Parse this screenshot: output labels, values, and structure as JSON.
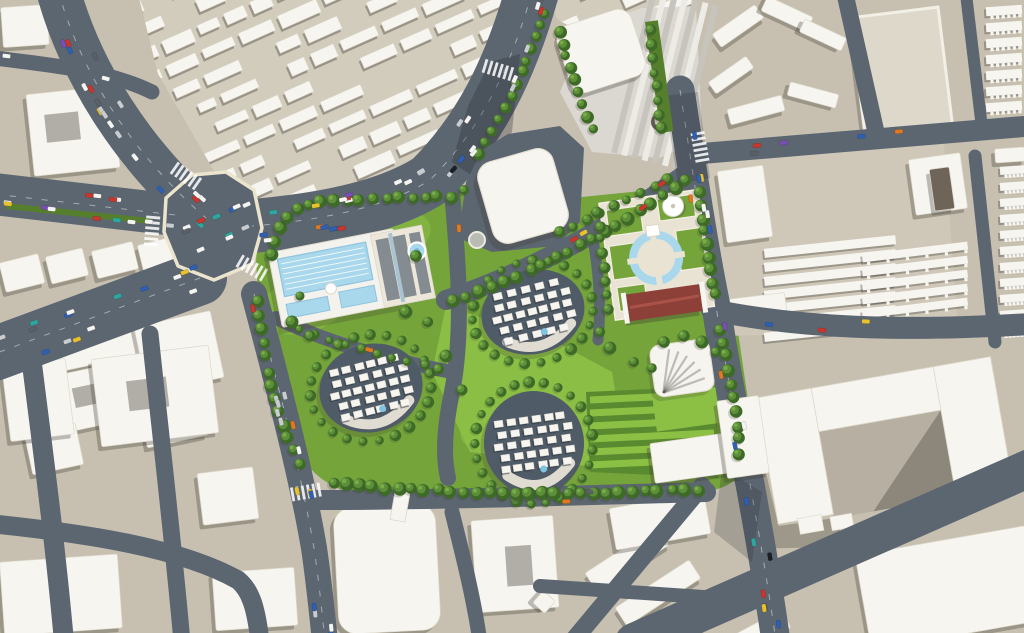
{
  "meta": {
    "kind": "aerial-3d-masterplan-rendering",
    "canvas_w": 1024,
    "canvas_h": 633
  },
  "palette": {
    "ground": "#c7c0b1",
    "ground_light": "#d2ccbd",
    "road": "#5c6671",
    "road_dark": "#4d5761",
    "curb": "#ece5cd",
    "white": "#f7f5f0",
    "white_edge": "#ddd8ca",
    "shadow": "#3e3a33",
    "lawn": "#75a43a",
    "lawn_bright": "#8cc045",
    "lawn_dark": "#567f2d",
    "hedge_base": "#5a8a30",
    "tree_dark": "#3e6a27",
    "tree_mid": "#5d8f3b",
    "tree_light": "#79ad46",
    "water": "#a9d8ec",
    "water_deep": "#7fbcd9",
    "cluster_ground": "#4f5b66",
    "plaza_cream": "#e9e3d4",
    "track_red": "#8d4038",
    "track_ridge": "#a85248",
    "roof_gray": "#848b91",
    "roof_spine": "#aac3d1",
    "complex_base": "#dbd8d1",
    "strip_dark": "#c6c4bd",
    "strip_light": "#edebe6",
    "tower_dark": "#6e6458",
    "court_tan": "#b6afa2",
    "plaza_tan": "#d9d3c4",
    "walkway": "#e8e4d8",
    "crescent": "#5f5a52"
  },
  "car_colors": [
    [
      "#f4f4f2",
      30
    ],
    [
      "#c9ccd0",
      16
    ],
    [
      "#5a6066",
      12
    ],
    [
      "#c8372d",
      9
    ],
    [
      "#2f5fb3",
      9
    ],
    [
      "#e8c22e",
      8
    ],
    [
      "#2da8a0",
      6
    ],
    [
      "#e07820",
      5
    ],
    [
      "#7a4fb5",
      3
    ],
    [
      "#1c1f24",
      2
    ]
  ],
  "roads": [
    {
      "name": "avenue-northwest",
      "d": "M 58,-10 C 80,70 130,152 206,218",
      "w": 44,
      "cars": 20,
      "dash": true
    },
    {
      "name": "avenue-top",
      "d": "M 532,-8 C 510,70 480,130 430,180 C 380,212 300,222 252,226",
      "w": 54,
      "cars": 30,
      "dash": true
    },
    {
      "name": "avenue-west",
      "d": "M -6,194 L 184,216",
      "w": 42,
      "cars": 13,
      "dash": true
    },
    {
      "name": "avenue-southwest",
      "d": "M 200,278 L -6,354",
      "w": 54,
      "cars": 15,
      "dash": true
    },
    {
      "name": "road-west-edge",
      "d": "M 254,294 C 282,400 302,478 314,548 C 319,582 322,612 325,642",
      "w": 26,
      "cars": 16,
      "dash": true
    },
    {
      "name": "road-east",
      "d": "M 680,90 C 692,168 704,248 716,306 C 726,372 740,440 750,484 C 758,528 768,584 776,642",
      "w": 29,
      "cars": 18,
      "dash": true
    },
    {
      "name": "road-dev-diagonal",
      "d": "M 446,300 C 540,268 626,218 694,168",
      "w": 20,
      "cars": 4
    },
    {
      "name": "road-dev-east-of-pool",
      "d": "M 452,192 C 458,260 464,330 452,392 C 446,420 442,452 448,478",
      "w": 16,
      "cars": 1
    },
    {
      "name": "road-dev-west-walk",
      "d": "M 276,318 C 340,348 400,362 452,372",
      "w": 14,
      "cars": 1
    },
    {
      "name": "path-dev-mid",
      "d": "M 590,224 C 598,262 602,300 598,340",
      "w": 11,
      "cars": 0
    },
    {
      "name": "road-dev-south",
      "d": "M 312,500 C 430,500 560,496 706,492",
      "w": 20,
      "cars": 2
    },
    {
      "name": "road-bottom-diagonal",
      "d": "M 702,486 L 572,642",
      "w": 18,
      "cars": 0
    },
    {
      "name": "road-bottom-branch",
      "d": "M 540,586 C 600,590 660,594 718,598",
      "w": 14,
      "cars": 0
    },
    {
      "name": "road-bottom-center",
      "d": "M 452,512 C 464,560 474,600 480,642",
      "w": 15,
      "cars": 0
    },
    {
      "name": "road-topright-horizontal",
      "d": "M 696,154 L 1030,126",
      "w": 21,
      "cars": 5
    },
    {
      "name": "road-topright-vertical",
      "d": "M 845,-6 L 876,132",
      "w": 17,
      "cars": 0
    },
    {
      "name": "road-topright-edge",
      "d": "M 966,-6 L 982,128",
      "w": 12,
      "cars": 0
    },
    {
      "name": "road-right-vertical",
      "d": "M 975,156 L 995,342",
      "w": 13,
      "cars": 0
    },
    {
      "name": "road-mid-right",
      "d": "M 712,310 C 800,328 900,332 1030,324",
      "w": 22,
      "cars": 3
    },
    {
      "name": "road-bottom-right",
      "d": "M 634,642 L 1030,468",
      "w": 38,
      "cars": 0
    },
    {
      "name": "road-bottomleft-v1",
      "d": "M 28,332 C 40,430 54,530 64,642",
      "w": 20,
      "cars": 0
    },
    {
      "name": "road-bottomleft-v2",
      "d": "M 150,334 C 160,430 172,530 182,642",
      "w": 17,
      "cars": 0
    },
    {
      "name": "road-bottomleft-h",
      "d": "M -6,524 C 90,534 180,548 238,580 C 250,590 256,606 260,642",
      "w": 19,
      "cars": 0
    },
    {
      "name": "road-topleft-spur",
      "d": "M -6,58 C 60,66 112,72 152,92",
      "w": 15,
      "cars": 2
    },
    {
      "name": "plaza-traffic",
      "d": "M 178,246 L 256,212",
      "w": 58,
      "cars": 11,
      "ghost": true
    }
  ],
  "intersection_plaza": {
    "name": "central-intersection",
    "points": "166,198 192,175 226,172 254,190 262,228 252,264 214,280 178,266 164,232"
  },
  "median": {
    "name": "avenue-west-median",
    "d": "M 6,206 L 150,221",
    "w": 6
  },
  "patches": [
    {
      "name": "building-shadow-on-avenue",
      "points": "452,162 468,106 490,62 520,54 512,132 478,180",
      "op": 0.3
    },
    {
      "name": "building-shadow-on-east-road",
      "points": "664,96 698,92 710,178 678,184",
      "op": 0.22
    },
    {
      "name": "tower-shadow-on-road",
      "points": "722,468 762,492 752,562 714,532",
      "op": 0.22
    }
  ],
  "zebras": [
    [
      186,
      176,
      35
    ],
    [
      152,
      231,
      95
    ],
    [
      252,
      268,
      30
    ],
    [
      700,
      147,
      80
    ],
    [
      306,
      492,
      -10
    ],
    [
      498,
      70,
      17
    ]
  ],
  "development": {
    "outline": "M 256,262 C 258,224 268,208 300,198 L 448,190 C 460,190 468,196 470,204 L 522,206 L 582,197 L 700,185 C 710,184 716,190 716,198 L 720,300 C 722,316 730,322 738,332 L 748,400 C 752,432 750,460 742,472 C 730,488 716,490 700,492 L 400,498 C 360,498 330,490 312,470 C 290,445 272,400 262,350 Z",
    "bright_patches": [
      [
        300,
        308,
        44,
        26,
        -10
      ],
      [
        372,
        240,
        60,
        30,
        -14
      ],
      [
        520,
        430,
        60,
        26,
        -5
      ]
    ],
    "central_lawn": "446,306 560,344 612,372 616,396 588,466 470,452 432,372",
    "hedges": {
      "base": "586,392 716,386 718,478 590,472",
      "rows": 6,
      "x0": 590,
      "x1": 714,
      "y0": 400,
      "dy": 13,
      "slope": -6
    },
    "clusters": [
      {
        "name": "residential-cluster-west",
        "cx": 371,
        "cy": 388,
        "rx": 52,
        "ry": 44,
        "rot": -14,
        "seed": 7
      },
      {
        "name": "residential-cluster-north",
        "cx": 533,
        "cy": 312,
        "rx": 52,
        "ry": 42,
        "rot": -14,
        "seed": 11
      },
      {
        "name": "residential-cluster-south",
        "cx": 534,
        "cy": 443,
        "rx": 50,
        "ry": 52,
        "rot": -8,
        "seed": 19
      }
    ],
    "pool": {
      "name": "swimming-pool-complex",
      "cx": 338,
      "cy": 278,
      "rot": -11
    },
    "pond": {
      "name": "round-pond",
      "cx": 417,
      "cy": 251,
      "r": 8.5
    },
    "planter": {
      "name": "round-planter",
      "cx": 477,
      "cy": 240,
      "r": 8
    },
    "apron": "458,238 466,182 482,150 508,134 560,126 584,148 580,222 556,246 492,252",
    "hall": {
      "name": "white-hall-building",
      "x": 484,
      "y": 154,
      "w": 78,
      "h": 84,
      "rot": -16,
      "r": 16
    },
    "ne_plaza": {
      "name": "fountain-plaza",
      "rot": -8,
      "cx": 655,
      "cy": 250,
      "plaza": [
        606,
        196,
        100,
        118
      ],
      "lawns": [
        [
          612,
          204,
          34,
          26
        ],
        [
          664,
          200,
          36,
          22
        ],
        [
          610,
          240,
          26,
          34
        ],
        [
          678,
          234,
          26,
          40
        ],
        [
          612,
          282,
          28,
          24
        ]
      ],
      "pool_r": 27,
      "island_r": 19,
      "center": [
        655,
        258
      ],
      "dome": {
        "cx": 679,
        "cy": 209,
        "r": 10.5
      },
      "red_building": {
        "x": 620,
        "y": 290,
        "w": 74,
        "h": 27
      }
    },
    "se_corner": {
      "canopy": {
        "cx": 682,
        "cy": 368,
        "rot": -8
      },
      "lawn": [
        652,
        396,
        64,
        36,
        -8
      ],
      "l_building": [
        [
          652,
          436,
          108,
          40,
          -8
        ],
        [
          722,
          398,
          42,
          78,
          -8
        ]
      ]
    },
    "bridge": {
      "name": "pedestrian-bridge",
      "x": 396,
      "y": 486,
      "w": 15,
      "h": 34,
      "rot": 10
    }
  },
  "tree_rows": [
    {
      "name": "trees-dev-north",
      "d": "M 272,254 C 278,220 296,206 322,202 L 444,196",
      "sp": 13,
      "r": 5.2
    },
    {
      "name": "trees-diagonal-south",
      "d": "M 452,302 C 540,272 628,222 692,176",
      "sp": 14,
      "r": 5.2
    },
    {
      "name": "trees-diagonal-north",
      "d": "M 560,232 C 610,210 650,190 678,172",
      "sp": 15,
      "r": 4.4
    },
    {
      "name": "trees-plaza-east",
      "d": "M 700,192 C 706,242 712,272 716,304",
      "sp": 13,
      "r": 5
    },
    {
      "name": "trees-plaza-west",
      "d": "M 598,212 C 602,250 606,285 610,318",
      "sp": 14,
      "r": 4.4
    },
    {
      "name": "trees-dev-south",
      "d": "M 334,484 C 450,494 560,496 700,490",
      "sp": 13,
      "r": 5.4
    },
    {
      "name": "trees-dev-west",
      "d": "M 258,302 C 264,364 282,432 300,464",
      "sp": 14,
      "r": 5.2
    },
    {
      "name": "trees-avenue-east",
      "d": "M 545,12 C 528,60 508,112 474,160",
      "sp": 13,
      "r": 4.8
    },
    {
      "name": "trees-se-corner",
      "d": "M 720,330 C 732,380 740,430 738,464",
      "sp": 14,
      "r": 5
    },
    {
      "name": "trees-complex-west",
      "d": "M 560,30 C 570,72 584,110 598,140",
      "sp": 13,
      "r": 4.6
    },
    {
      "name": "trees-green-strip",
      "d": "M 650,30 L 662,132",
      "sp": 14,
      "r": 4.4
    },
    {
      "name": "trees-inner-walk",
      "d": "M 300,330 C 360,352 410,362 448,370",
      "sp": 16,
      "r": 3.8
    }
  ],
  "tree_singles": [
    [
      416,
      256
    ],
    [
      428,
      322
    ],
    [
      446,
      356
    ],
    [
      462,
      390
    ],
    [
      610,
      348
    ],
    [
      634,
      362
    ],
    [
      652,
      368
    ],
    [
      600,
      332
    ],
    [
      292,
      322
    ],
    [
      310,
      336
    ],
    [
      406,
      312
    ],
    [
      300,
      296
    ],
    [
      664,
      342
    ],
    [
      684,
      336
    ],
    [
      702,
      342
    ],
    [
      716,
      352
    ],
    [
      452,
      198
    ],
    [
      464,
      190
    ]
  ],
  "green_strip": {
    "name": "green-median-strip",
    "x": 645,
    "y": 22,
    "w": 13,
    "h": 112,
    "rot": -8
  },
  "fabric_regions": [
    {
      "name": "city-fabric-northwest",
      "clip": "138,-6 516,-6 496,54 462,110 430,160 382,196 330,206 240,216 158,74",
      "rot": -24,
      "cx": 320,
      "cy": 100,
      "x0": -60,
      "x1": 640,
      "y0": -90,
      "y1": 300,
      "row": 24,
      "seed": 3
    },
    {
      "name": "city-fabric-north",
      "clip": "544,-6 692,-6 690,32 640,58 600,42 558,20",
      "rot": -24,
      "cx": 610,
      "cy": 20,
      "x0": 440,
      "x1": 750,
      "y0": -70,
      "y1": 90,
      "row": 24,
      "seed": 5
    }
  ],
  "buildings": [
    {
      "name": "block-topleft-a",
      "x": 2,
      "y": 6,
      "w": 46,
      "h": 40,
      "rot": -4
    },
    {
      "name": "block-topleft-b",
      "x": 30,
      "y": 90,
      "w": 86,
      "h": 82,
      "rot": -6,
      "notch": [
        46,
        112,
        34,
        28
      ]
    },
    {
      "name": "block-west-1",
      "x": 2,
      "y": 258,
      "w": 40,
      "h": 30,
      "rot": -14
    },
    {
      "name": "block-west-2",
      "x": 48,
      "y": 252,
      "w": 38,
      "h": 28,
      "rot": -14
    },
    {
      "name": "block-west-3",
      "x": 94,
      "y": 246,
      "w": 42,
      "h": 28,
      "rot": -14
    },
    {
      "name": "block-west-4",
      "x": 140,
      "y": 240,
      "w": 42,
      "h": 28,
      "rot": -14
    },
    {
      "name": "block-west-5",
      "x": 52,
      "y": 302,
      "w": 82,
      "h": 62,
      "rot": -12,
      "notch": [
        82,
        318,
        26,
        22
      ]
    },
    {
      "name": "block-west-6",
      "x": 140,
      "y": 318,
      "w": 78,
      "h": 68,
      "rot": -12
    },
    {
      "name": "block-west-7",
      "x": 58,
      "y": 368,
      "w": 72,
      "h": 58,
      "rot": -12,
      "notch": [
        74,
        384,
        24,
        20
      ]
    },
    {
      "name": "block-west-8",
      "x": 142,
      "y": 396,
      "w": 62,
      "h": 46,
      "rot": -12
    },
    {
      "name": "block-west-9",
      "x": 28,
      "y": 428,
      "w": 52,
      "h": 42,
      "rot": -12
    },
    {
      "name": "block-southwest-1",
      "x": 96,
      "y": 352,
      "w": 118,
      "h": 88,
      "rot": -7,
      "notch": [
        128,
        378,
        40,
        30
      ]
    },
    {
      "name": "block-southwest-2",
      "x": 6,
      "y": 362,
      "w": 64,
      "h": 76,
      "rot": -7
    },
    {
      "name": "block-southwest-3",
      "x": 200,
      "y": 470,
      "w": 56,
      "h": 52,
      "rot": -7
    },
    {
      "name": "block-southwest-4",
      "x": 2,
      "y": 558,
      "w": 118,
      "h": 74,
      "rot": -4
    },
    {
      "name": "block-southwest-5",
      "x": 214,
      "y": 570,
      "w": 82,
      "h": 58,
      "rot": -4
    },
    {
      "name": "block-bottomcenter-rounded",
      "x": 336,
      "y": 506,
      "w": 102,
      "h": 126,
      "rot": -3,
      "r": 18
    },
    {
      "name": "block-bottomcenter-u",
      "x": 474,
      "y": 518,
      "w": 82,
      "h": 92,
      "rot": -4,
      "notch": [
        506,
        546,
        26,
        40
      ]
    },
    {
      "name": "block-bottomcenter-diamond",
      "x": 536,
      "y": 594,
      "w": 16,
      "h": 16,
      "rot": 42
    },
    {
      "name": "block-bottom-slab-1",
      "x": 584,
      "y": 548,
      "w": 86,
      "h": 22,
      "rot": -33
    },
    {
      "name": "block-bottom-slab-2",
      "x": 614,
      "y": 582,
      "w": 88,
      "h": 22,
      "rot": -33
    },
    {
      "name": "block-south-slab",
      "x": 612,
      "y": 500,
      "w": 96,
      "h": 42,
      "rot": -10
    },
    {
      "name": "block-bottom-thin-1",
      "x": 688,
      "y": 594,
      "w": 62,
      "h": 24,
      "rot": -28
    },
    {
      "name": "block-bottom-thin-2",
      "x": 724,
      "y": 624,
      "w": 66,
      "h": 20,
      "rot": -28
    },
    {
      "name": "slab-bottomright",
      "x": 862,
      "y": 540,
      "w": 172,
      "h": 96,
      "rot": -10
    },
    {
      "name": "zigzag-1",
      "x": 712,
      "y": 18,
      "w": 52,
      "h": 16,
      "rot": -35
    },
    {
      "name": "zigzag-2",
      "x": 762,
      "y": 6,
      "w": 50,
      "h": 16,
      "rot": 25
    },
    {
      "name": "zigzag-3",
      "x": 708,
      "y": 68,
      "w": 46,
      "h": 14,
      "rot": -35
    },
    {
      "name": "zigzag-4",
      "x": 800,
      "y": 28,
      "w": 46,
      "h": 14,
      "rot": 25
    },
    {
      "name": "zigzag-5",
      "x": 728,
      "y": 102,
      "w": 56,
      "h": 16,
      "rot": -15
    },
    {
      "name": "zigzag-6",
      "x": 788,
      "y": 88,
      "w": 50,
      "h": 14,
      "rot": 15
    },
    {
      "name": "plazablock-west-slab",
      "x": 722,
      "y": 168,
      "w": 46,
      "h": 72,
      "rot": -8
    },
    {
      "name": "plazablock-l-building",
      "x": 912,
      "y": 156,
      "w": 52,
      "h": 56,
      "rot": -8
    },
    {
      "name": "plazablock-tower",
      "x": 932,
      "y": 168,
      "w": 20,
      "h": 42,
      "rot": -8,
      "fill": "#6e6458"
    },
    {
      "name": "plazablock-south-1",
      "x": 726,
      "y": 296,
      "w": 60,
      "h": 22,
      "rot": -7
    },
    {
      "name": "rightedge-slab-top",
      "x": 995,
      "y": 148,
      "w": 30,
      "h": 14,
      "rot": -4
    }
  ],
  "block_bases": [
    {
      "name": "plaza-block-ground",
      "points": "706,162 944,144 958,330 724,336",
      "fill": "#cfc8b9"
    },
    {
      "name": "complex-plaza-ground",
      "points": "640,100 700,96 702,148 656,154",
      "fill": "#d9d3c4"
    }
  ],
  "slab_rows": [
    {
      "name": "plazablock-slab-rows",
      "x": 764,
      "y": 242,
      "count": 7,
      "step": 14,
      "w": 132,
      "h": 9,
      "rot": -6,
      "teeth": false
    },
    {
      "name": "plazablock-comb-rows",
      "x": 862,
      "y": 248,
      "count": 5,
      "step": 14,
      "w": 106,
      "h": 8,
      "rot": -7,
      "teeth": true
    },
    {
      "name": "rightedge-combs-top",
      "x": 986,
      "y": 6,
      "count": 8,
      "step": 16,
      "w": 36,
      "h": 9,
      "rot": -4,
      "teeth": true
    },
    {
      "name": "rightedge-combs-mid",
      "x": 1000,
      "y": 166,
      "count": 11,
      "step": 16,
      "w": 28,
      "h": 8,
      "rot": -4,
      "teeth": true
    }
  ],
  "superblock": {
    "name": "superblock-flat-roof",
    "x": 858,
    "y": 12,
    "w": 88,
    "h": 126,
    "rot": -7
  },
  "complex": {
    "name": "shopping-complex",
    "base": "560,92 588,26 642,8 696,6 702,138 660,158 592,152",
    "white_slab": {
      "x": 562,
      "y": 16,
      "w": 78,
      "h": 70,
      "rot": -18,
      "r": 14
    },
    "strips": {
      "rot": 14,
      "cx": 660,
      "cy": 80,
      "x0": 630,
      "x1": 696,
      "step": 10.5,
      "y0": -6,
      "y1": 162,
      "w": 6
    },
    "crescent": {
      "cx": 660,
      "cy": 122,
      "r": 9
    }
  },
  "tower": {
    "name": "white-u-tower",
    "tx": 756,
    "ty": 398,
    "rot": -10,
    "wings": [
      [
        0,
        0,
        238,
        44
      ],
      [
        0,
        0,
        56,
        128
      ],
      [
        180,
        0,
        58,
        132
      ]
    ],
    "courtyard": [
      56,
      44,
      124,
      88
    ],
    "cubes": [
      [
        20,
        126,
        24,
        16
      ],
      [
        52,
        130,
        22,
        14
      ]
    ]
  }
}
